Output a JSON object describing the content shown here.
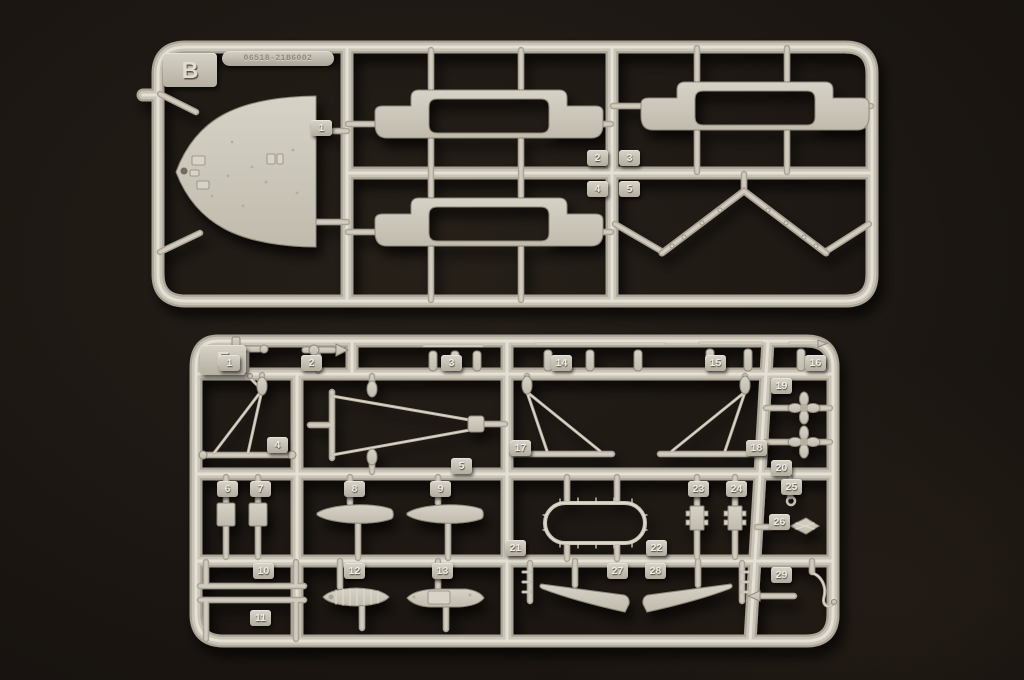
{
  "scene": {
    "type": "photograph",
    "subject": "Two light-grey injection-moulded polystyrene model-kit part sprues (runners) lying on a black surface",
    "background_color": "#151110",
    "plastic_color": "#cbc6b9",
    "plastic_highlight": "#e6e2d6",
    "plastic_shadow": "#8e887b"
  },
  "sprue_b": {
    "letter": "B",
    "mold_stamp": "06518-21B6002",
    "part_tags": [
      "1",
      "2",
      "3",
      "4",
      "5"
    ],
    "parts": [
      {
        "number": "1",
        "shape": "pointed bow deck piece with small moulded fittings and bollards"
      },
      {
        "number": "2",
        "shape": "stepped bridge platform with large rounded rectangular opening"
      },
      {
        "number": "3",
        "shape": "stepped bridge platform with large rounded rectangular opening"
      },
      {
        "number": "4",
        "shape": "stepped bridge platform with large rounded rectangular opening"
      },
      {
        "number": "5",
        "shape": "chevron-shaped yardarm with small studs"
      }
    ]
  },
  "sprue_f": {
    "letter": "F",
    "part_tags": [
      "1",
      "2",
      "3",
      "4",
      "5",
      "6",
      "7",
      "8",
      "9",
      "10",
      "11",
      "12",
      "13",
      "14",
      "15",
      "16",
      "17",
      "18",
      "19",
      "20",
      "21",
      "22",
      "23",
      "24",
      "25",
      "26",
      "27",
      "28",
      "29"
    ],
    "parts": [
      {
        "number": "1",
        "shape": "small deck fitting with upright grip"
      },
      {
        "number": "2",
        "shape": "tapered spindle cylinder"
      },
      {
        "number": "3",
        "shape": "row of small bollard posts"
      },
      {
        "number": "4",
        "shape": "triangular mast frame with pod"
      },
      {
        "number": "5",
        "shape": "large V-shaped mast with crossbar"
      },
      {
        "number": "6",
        "shape": "small rectangular mounting plate"
      },
      {
        "number": "7",
        "shape": "small rectangular mounting plate"
      },
      {
        "number": "8",
        "shape": "half boat hull"
      },
      {
        "number": "9",
        "shape": "half boat hull"
      },
      {
        "number": "10",
        "shape": "long thin rod"
      },
      {
        "number": "11",
        "shape": "long thin rod"
      },
      {
        "number": "12",
        "shape": "open lifeboat with thwarts"
      },
      {
        "number": "13",
        "shape": "motor launch with cabin"
      },
      {
        "number": "14",
        "shape": "row of small bollard posts on bar"
      },
      {
        "number": "15",
        "shape": "bollard posts with thin rod"
      },
      {
        "number": "16",
        "shape": "bollard post with pointed rod"
      },
      {
        "number": "17",
        "shape": "derrick mast frame, left-hand"
      },
      {
        "number": "18",
        "shape": "derrick mast frame, right-hand"
      },
      {
        "number": "19",
        "shape": "four-blade propeller on shaft"
      },
      {
        "number": "20",
        "shape": "four-blade propeller on shaft"
      },
      {
        "number": "21",
        "shape": "oval railing ring frame"
      },
      {
        "number": "22",
        "shape": "oval railing ring frame"
      },
      {
        "number": "23",
        "shape": "stepped bracket fitting"
      },
      {
        "number": "24",
        "shape": "stepped bracket fitting"
      },
      {
        "number": "25",
        "shape": "pin with small eyelet"
      },
      {
        "number": "26",
        "shape": "small finned fitting"
      },
      {
        "number": "27",
        "shape": "curved hull skeg, left-hand"
      },
      {
        "number": "28",
        "shape": "curved hull skeg, right-hand"
      },
      {
        "number": "29",
        "shape": "curved boat davit with ball tip"
      }
    ]
  }
}
